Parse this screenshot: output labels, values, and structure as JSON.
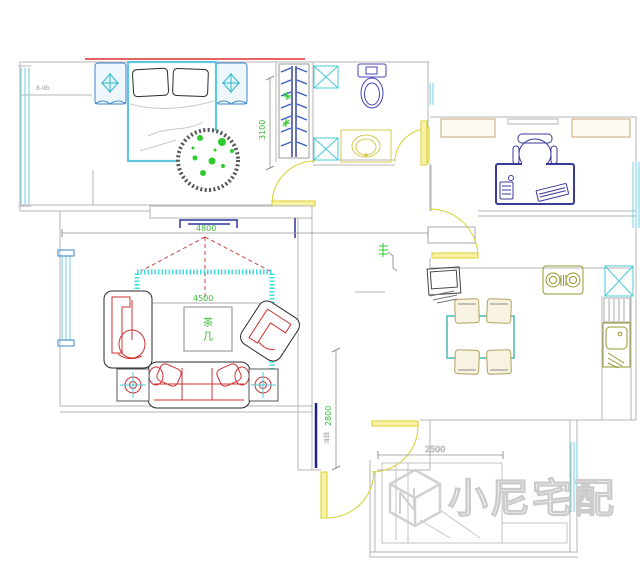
{
  "watermark": {
    "logo": "cube-n-logo",
    "text": "小尼宅配"
  },
  "dimensions": {
    "living_room_width": "4800",
    "master_bedroom_depth": "3100",
    "living_rug_width": "4500",
    "hallway_depth": "2800",
    "second_bedroom_width": "2500"
  },
  "labels": {
    "coffee_table_char1": "茶",
    "coffee_table_char2": "几",
    "balcony_note": "8-9b",
    "shoe_cabinet": "鞋柜"
  },
  "colors": {
    "wall_gray": "#b5b5b5",
    "window_cyan": "#6fd2e4",
    "door_yellow": "#e8df45",
    "furniture_red": "#cc3333",
    "dimension_green": "#3db83d",
    "fixture_blue": "#3a49b0",
    "kitchen_olive": "#97972e",
    "rug_cyan": "#3cdede",
    "accent_red_line": "#e03030",
    "watermark_gray": "#cccccc"
  }
}
